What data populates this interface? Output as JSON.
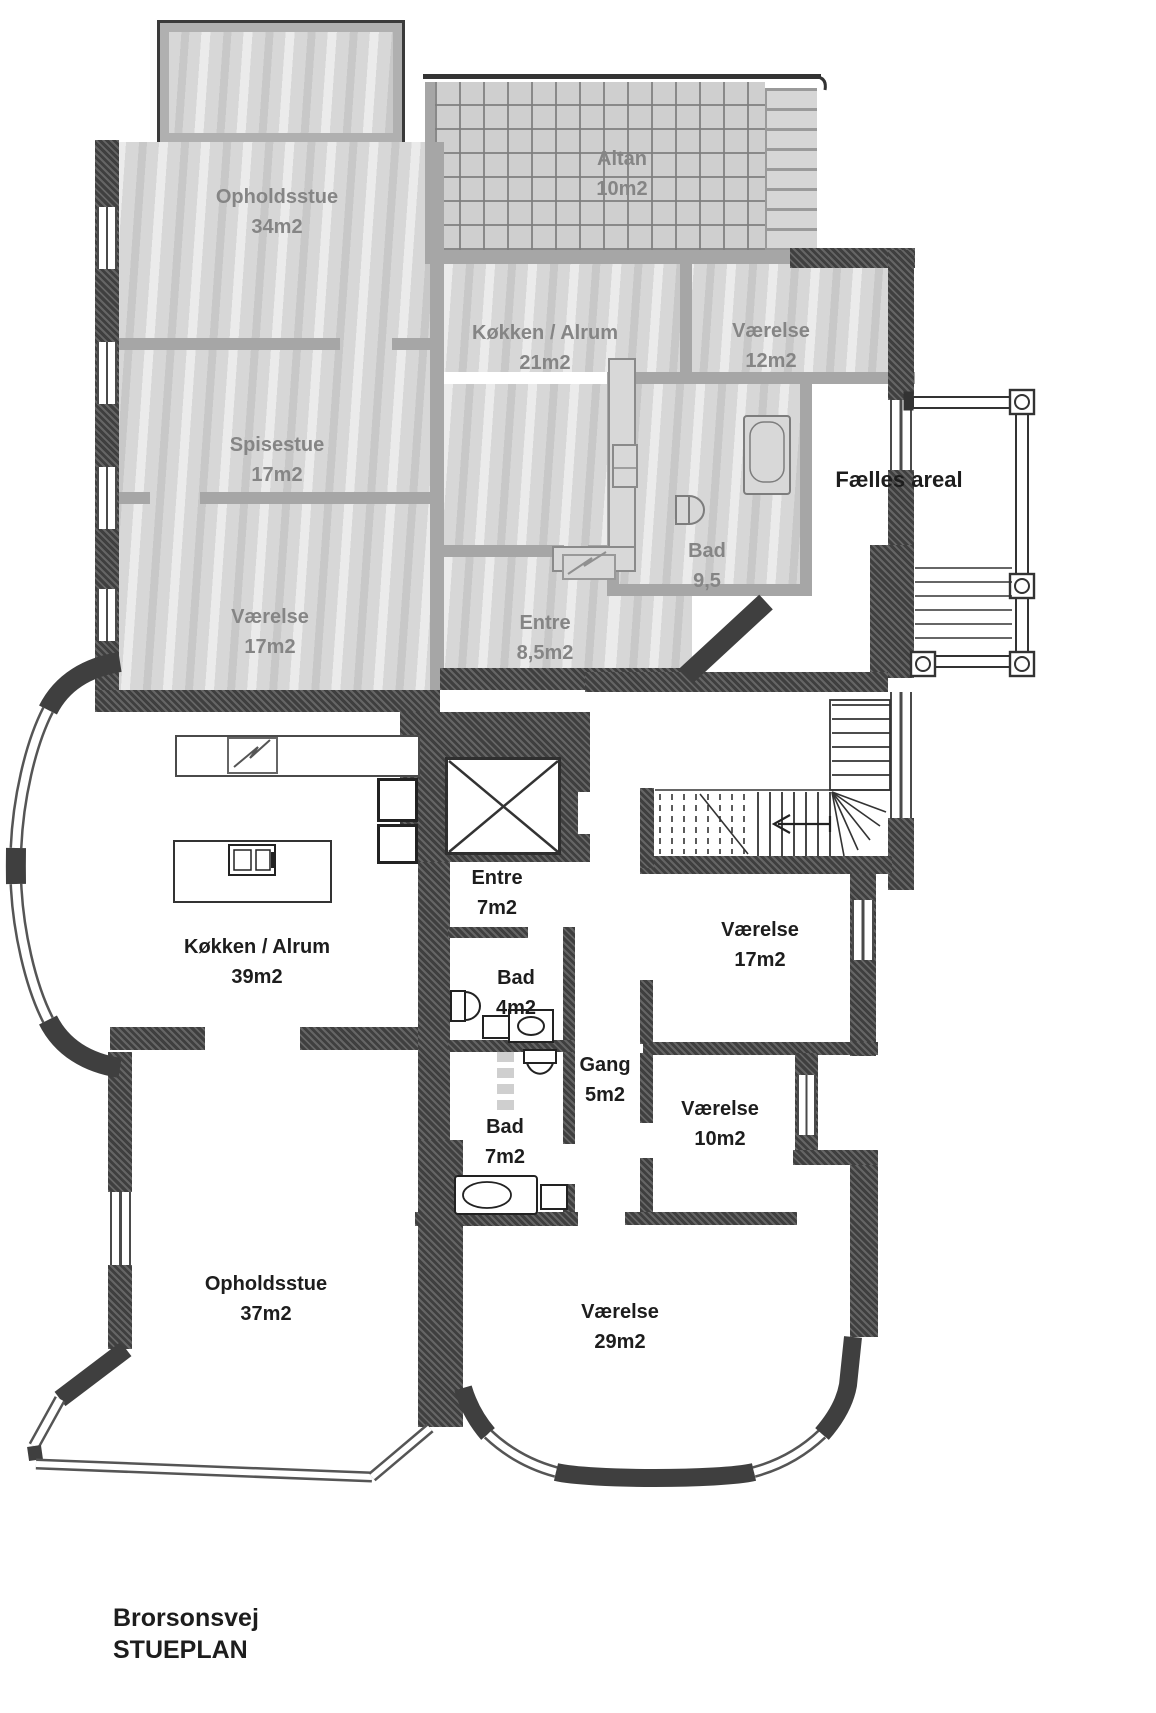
{
  "title": {
    "address": "Brorsonsvej",
    "plan": "STUEPLAN"
  },
  "common": {
    "label": "Fælles areal"
  },
  "upper_unit": {
    "description": "grayed-out upper floor unit",
    "rooms": [
      {
        "name": "Opholdsstue",
        "area": "34m2"
      },
      {
        "name": "Spisestue",
        "area": "17m2"
      },
      {
        "name": "Værelse",
        "area": "17m2"
      },
      {
        "name": "Altan",
        "area": "10m2"
      },
      {
        "name": "Køkken / Alrum",
        "area": "21m2"
      },
      {
        "name": "Værelse",
        "area": "12m2"
      },
      {
        "name": "Bad",
        "area": "9,5"
      },
      {
        "name": "Entre",
        "area": "8,5m2"
      }
    ]
  },
  "lower_unit": {
    "description": "ground floor unit",
    "rooms": [
      {
        "name": "Entre",
        "area": "7m2"
      },
      {
        "name": "Værelse",
        "area": "17m2"
      },
      {
        "name": "Køkken / Alrum",
        "area": "39m2"
      },
      {
        "name": "Bad",
        "area": "4m2"
      },
      {
        "name": "Gang",
        "area": "5m2"
      },
      {
        "name": "Bad",
        "area": "7m2"
      },
      {
        "name": "Værelse",
        "area": "10m2"
      },
      {
        "name": "Opholdsstue",
        "area": "37m2"
      },
      {
        "name": "Værelse",
        "area": "29m2"
      }
    ]
  },
  "colors": {
    "wall_dark": "#3f3f3f",
    "wall_gray": "#a6a6a6",
    "gray_wash": "#d7d7d7",
    "label_gray": "#858585",
    "label_dark": "#1d1d1d"
  }
}
